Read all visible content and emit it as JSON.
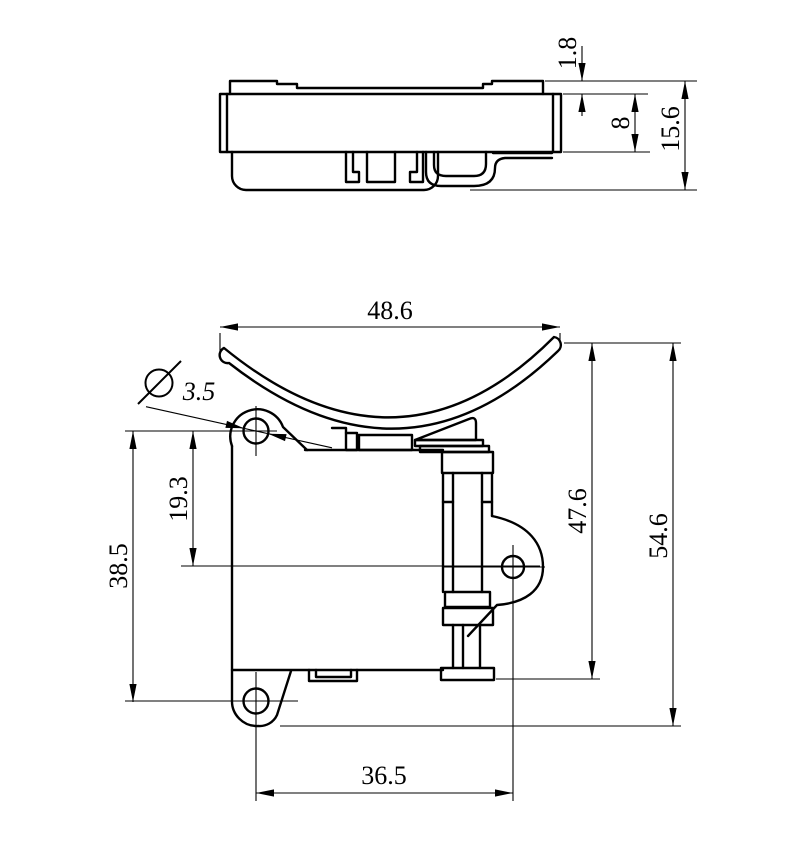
{
  "drawing": {
    "background": "#ffffff",
    "line_color": "#000000",
    "views": {
      "side_view": {
        "dims": {
          "flange_thickness": "1.8",
          "body_thickness": "8",
          "overall_thickness": "15.6"
        }
      },
      "front_view": {
        "dims": {
          "overall_width": "48.6",
          "hole_diameter_symbol": "Ø",
          "hole_diameter": "3.5",
          "hole_to_centerline": "19.3",
          "hole_vertical_spacing": "38.5",
          "side_height": "47.6",
          "overall_height": "54.6",
          "hole_horizontal_spacing": "36.5"
        }
      }
    }
  }
}
